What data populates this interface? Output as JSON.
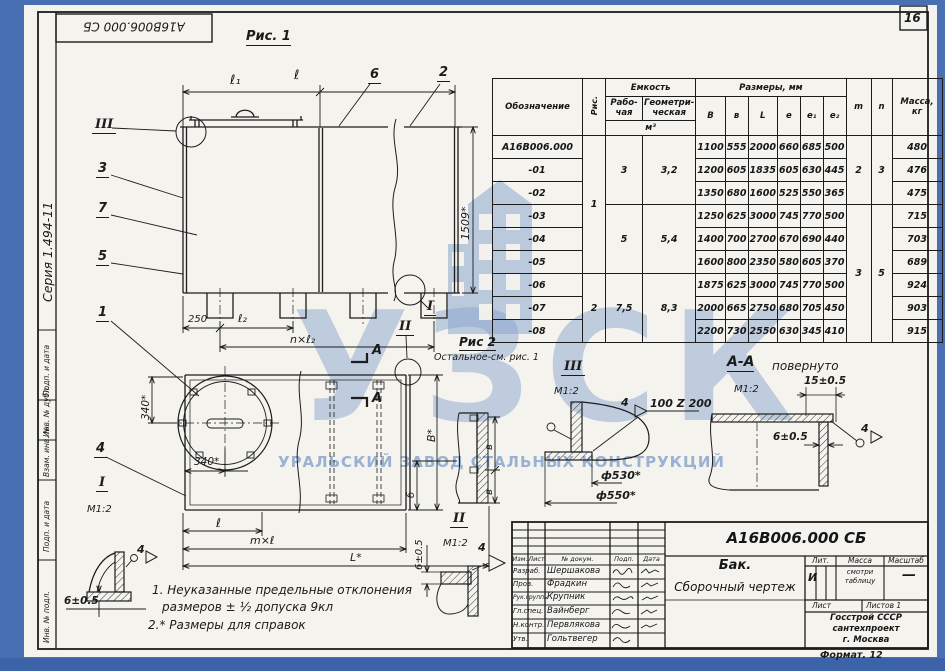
{
  "page": {
    "sheet_number": "16",
    "series_label": "Серия 1.494-11",
    "top_stamp": "А16В006.000 СБ",
    "format_note": "Формат. 12"
  },
  "watermark": {
    "acronym": "УЗСК",
    "full_name": "УРАЛЬСКИЙ ЗАВОД СТАЛЬНЫХ КОНСТРУКЦИЙ",
    "color": "#8aa6ce"
  },
  "margin_labels": [
    "Подп. и дата",
    "Инв. № дубл.",
    "Взам. инв. №",
    "Подп. и дата",
    "Инв. № подл."
  ],
  "fig1": {
    "caption": "Рис. 1",
    "dim_l1": "ℓ₁",
    "dim_l": "ℓ",
    "dim_height": "1509*",
    "dim_250": "250",
    "dim_l2": "ℓ₂",
    "dim_nl2": "n×ℓ₂",
    "callout_1": "1",
    "callout_2": "2",
    "callout_3": "3",
    "callout_5": "5",
    "callout_6": "6",
    "callout_7": "7",
    "marker_I": "I",
    "marker_II": "II",
    "marker_III": "III"
  },
  "fig2": {
    "caption": "Рис 2",
    "caption_note": "Остальное-см. рис. 1",
    "dim_340v": "340*",
    "dim_340h": "340*",
    "callout_4": "4",
    "marker_I": "I",
    "scale_I": "М1:2",
    "dim_l": "ℓ",
    "dim_ml": "m×ℓ",
    "dim_L": "L*",
    "dim_B": "В*",
    "dim_b1": "в",
    "dim_b2": "в",
    "dim_b_small": "б",
    "section_label_top": "А",
    "section_label_bottom": "А"
  },
  "detail_I": {
    "dim_6": "6±0.5",
    "weld_num": "4"
  },
  "detail_II": {
    "marker": "II",
    "scale": "М1:2",
    "weld_num": "4",
    "dim_6": "6±0.5"
  },
  "detail_III": {
    "marker": "III",
    "scale": "М1:2",
    "weld_num": "4",
    "weld_spec": "100 Z 200",
    "dim_d530": "ф530*",
    "dim_d550": "ф550*"
  },
  "detail_AA": {
    "title": "А-А",
    "title_note": "повернуто",
    "scale": "М1:2",
    "dim_15": "15±0.5",
    "dim_6": "6±0.5",
    "weld_num": "4"
  },
  "notes": [
    "1. Неуказанные предельные отклонения",
    "размеров ± ½ допуска 9кл",
    "2.* Размеры для справок"
  ],
  "table": {
    "headers": {
      "designation": "Обозначение",
      "fig": "Рис.",
      "capacity": "Емкость",
      "capacity_working": "Рабо-чая",
      "capacity_geometric": "Геометри-ческая",
      "capacity_units": "м³",
      "dimensions": "Размеры, мм",
      "dim_cols": [
        "В",
        "в",
        "L",
        "е",
        "е₁",
        "е₂"
      ],
      "col_m": "m",
      "col_n": "n",
      "mass": "Масса,",
      "mass_units": "кг"
    },
    "rows": [
      {
        "designation": "А16В006.000",
        "dims": [
          "1100",
          "555",
          "2000",
          "660",
          "685",
          "500"
        ],
        "mass": "480"
      },
      {
        "designation": "-01",
        "dims": [
          "1200",
          "605",
          "1835",
          "605",
          "630",
          "445"
        ],
        "mass": "476"
      },
      {
        "designation": "-02",
        "dims": [
          "1350",
          "680",
          "1600",
          "525",
          "550",
          "365"
        ],
        "mass": "475"
      },
      {
        "designation": "-03",
        "dims": [
          "1250",
          "625",
          "3000",
          "745",
          "770",
          "500"
        ],
        "mass": "715"
      },
      {
        "designation": "-04",
        "dims": [
          "1400",
          "700",
          "2700",
          "670",
          "690",
          "440"
        ],
        "mass": "703"
      },
      {
        "designation": "-05",
        "dims": [
          "1600",
          "800",
          "2350",
          "580",
          "605",
          "370"
        ],
        "mass": "689"
      },
      {
        "designation": "-06",
        "dims": [
          "1875",
          "625",
          "3000",
          "745",
          "770",
          "500"
        ],
        "mass": "924"
      },
      {
        "designation": "-07",
        "dims": [
          "2000",
          "665",
          "2750",
          "680",
          "705",
          "450"
        ],
        "mass": "903"
      },
      {
        "designation": "-08",
        "dims": [
          "2200",
          "730",
          "2550",
          "630",
          "345",
          "410"
        ],
        "mass": "915"
      }
    ],
    "merged": {
      "fig": [
        {
          "value": "1",
          "start": 0,
          "span": 6
        },
        {
          "value": "2",
          "start": 6,
          "span": 3
        }
      ],
      "capacity_working": [
        {
          "value": "3",
          "start": 0,
          "span": 3
        },
        {
          "value": "5",
          "start": 3,
          "span": 3
        },
        {
          "value": "7,5",
          "start": 6,
          "span": 3
        }
      ],
      "capacity_geometric": [
        {
          "value": "3,2",
          "start": 0,
          "span": 3
        },
        {
          "value": "5,4",
          "start": 3,
          "span": 3
        },
        {
          "value": "8,3",
          "start": 6,
          "span": 3
        }
      ],
      "m": [
        {
          "value": "2",
          "start": 0,
          "span": 3
        },
        {
          "value": "3",
          "start": 3,
          "span": 6
        }
      ],
      "n": [
        {
          "value": "3",
          "start": 0,
          "span": 3
        },
        {
          "value": "5",
          "start": 3,
          "span": 6
        }
      ]
    }
  },
  "title_block": {
    "doc_number": "А16В006.000 СБ",
    "product_name": "Бак.",
    "doc_type": "Сборочный чертеж",
    "header_cols": [
      "Изм.",
      "Лист",
      "№ докум.",
      "Подп.",
      "Дата"
    ],
    "rows": [
      {
        "role": "Разраб.",
        "name": "Шершакова"
      },
      {
        "role": "Пров.",
        "name": "Фрадкин"
      },
      {
        "role": "Рук.группы",
        "name": "Крупник"
      },
      {
        "role": "Гл.спец.",
        "name": "Вайнберг"
      },
      {
        "role": "Н.контр.",
        "name": "Первлякова"
      },
      {
        "role": "Утв.",
        "name": "Гольтвегер"
      }
    ],
    "lit_label": "Лит.",
    "lit_value": "И",
    "mass_label": "Масса",
    "mass_value_line1": "смотри",
    "mass_value_line2": "таблицу",
    "scale_label": "Масштаб",
    "scale_value": "—",
    "sheet_label": "Лист",
    "sheets_label": "Листов 1",
    "organization": [
      "Госстрой СССР",
      "сантехпроект",
      "г. Москва"
    ]
  }
}
